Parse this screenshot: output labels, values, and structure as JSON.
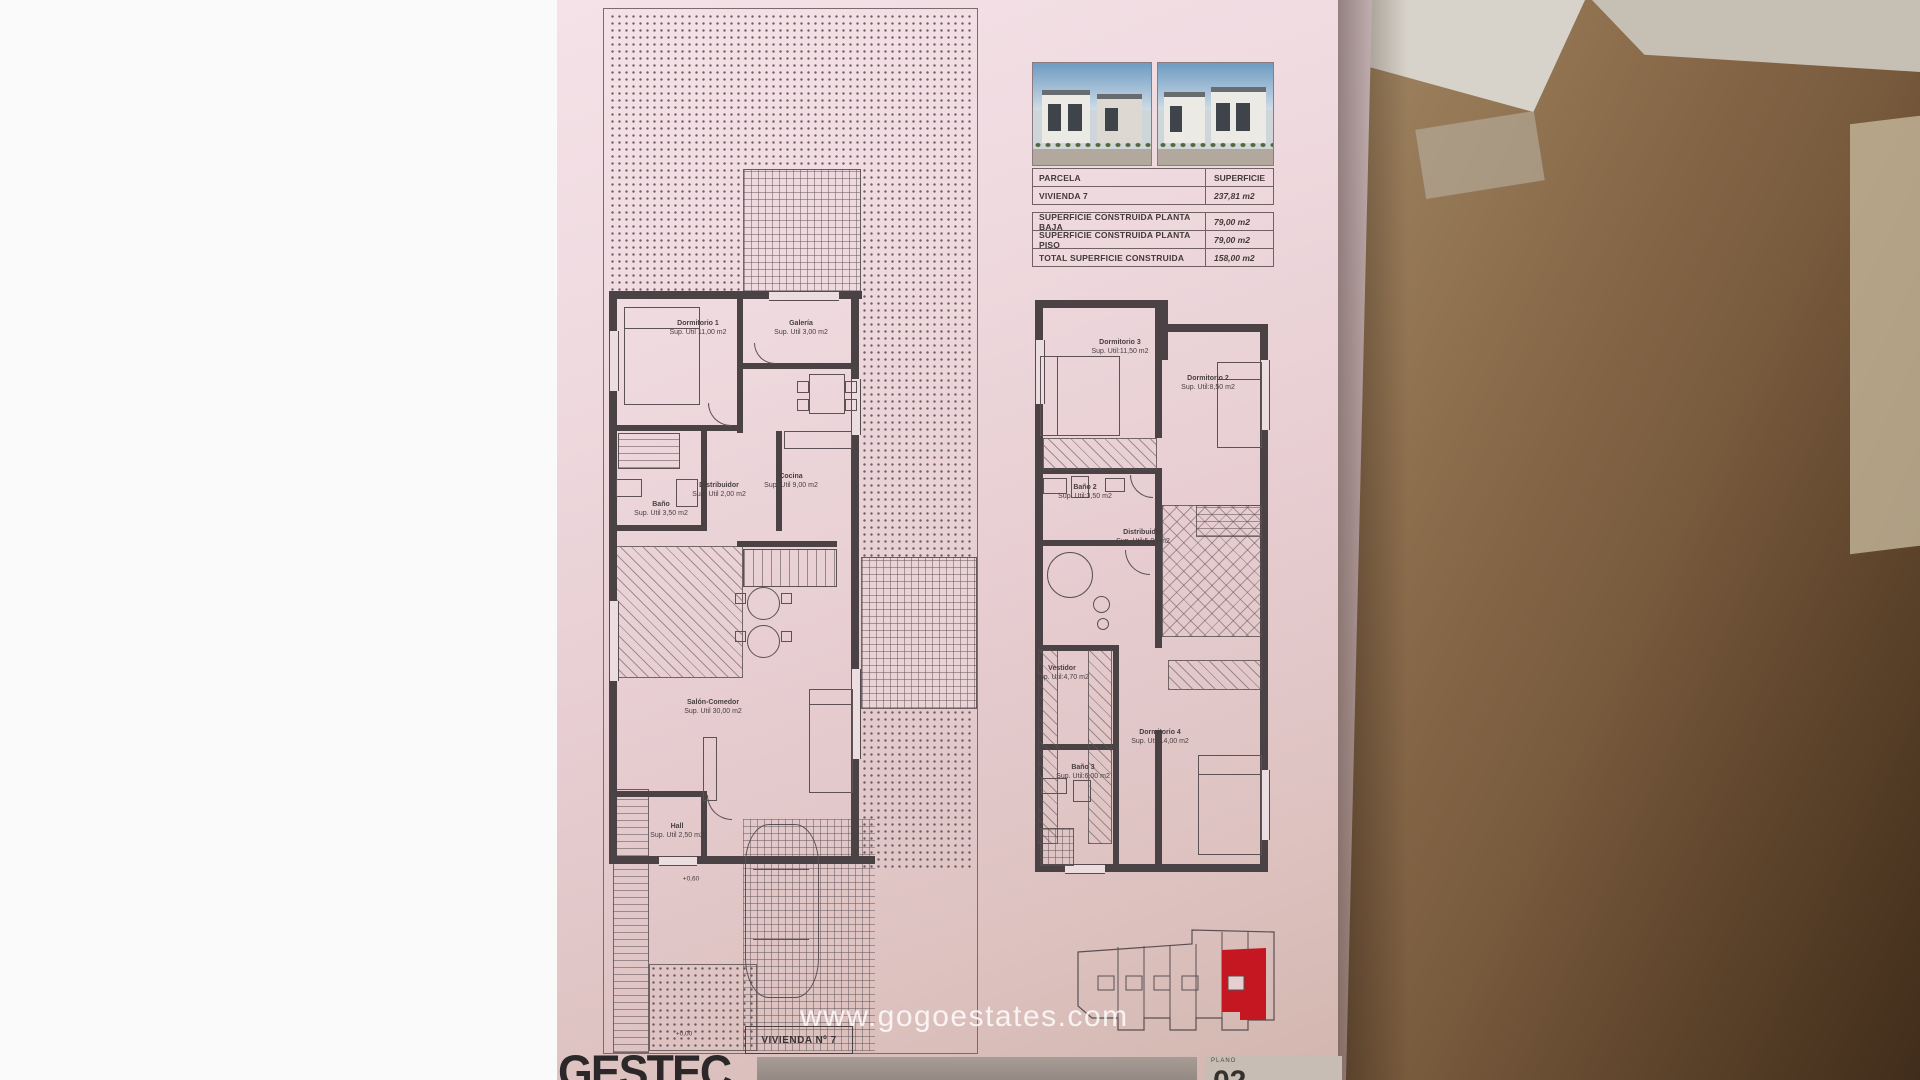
{
  "watermark": {
    "text": "www.gogoestates.com"
  },
  "summary_table": {
    "header_label": "PARCELA",
    "header_value": "SUPERFICIE",
    "parcel_label": "VIVIENDA 7",
    "parcel_value": "237,81 m2",
    "rows": [
      {
        "label": "SUPERFICIE CONSTRUIDA PLANTA BAJA",
        "value": "79,00 m2"
      },
      {
        "label": "SUPERFICIE CONSTRUIDA PLANTA PISO",
        "value": "79,00 m2"
      },
      {
        "label": "TOTAL SUPERFICIE CONSTRUIDA",
        "value": "158,00 m2"
      }
    ]
  },
  "ground_floor": {
    "rooms": [
      {
        "name": "Dormitorio 1",
        "area": "Sup. Util 11,00 m2"
      },
      {
        "name": "Galería",
        "area": "Sup. Util 3,00 m2"
      },
      {
        "name": "Distribuidor",
        "area": "Sup. Util 2,00 m2"
      },
      {
        "name": "Cocina",
        "area": "Sup. Util 9,00 m2"
      },
      {
        "name": "Baño",
        "area": "Sup. Util 3,50 m2"
      },
      {
        "name": "Salón-Comedor",
        "area": "Sup. Util 30,00 m2"
      },
      {
        "name": "Hall",
        "area": "Sup. Util 2,50 m2"
      }
    ],
    "levels": {
      "garage": "+0,60",
      "entry": "+0,00"
    },
    "unit_label": "VIVIENDA Nº 7"
  },
  "first_floor": {
    "rooms": [
      {
        "name": "Dormitorio 3",
        "area": "Sup. Util:11,50 m2"
      },
      {
        "name": "Dormitorio 2",
        "area": "Sup. Util:8,50 m2"
      },
      {
        "name": "Baño 2",
        "area": "Sup. Util:3,50 m2"
      },
      {
        "name": "Distribuidor",
        "area": "Sup. Util:5,00 m2"
      },
      {
        "name": "Vestidor",
        "area": "Sup. Util:4,70 m2"
      },
      {
        "name": "Dormitorio 4",
        "area": "Sup. Util:14,00 m2"
      },
      {
        "name": "Baño 3",
        "area": "Sup. Util:6,00 m2"
      }
    ]
  },
  "title_block": {
    "brand": "GESTEC",
    "plano_label": "PLANO",
    "plano_number": "02"
  },
  "colors": {
    "highlight_red": "#c41722",
    "paper_pink": "#ecd6da"
  }
}
